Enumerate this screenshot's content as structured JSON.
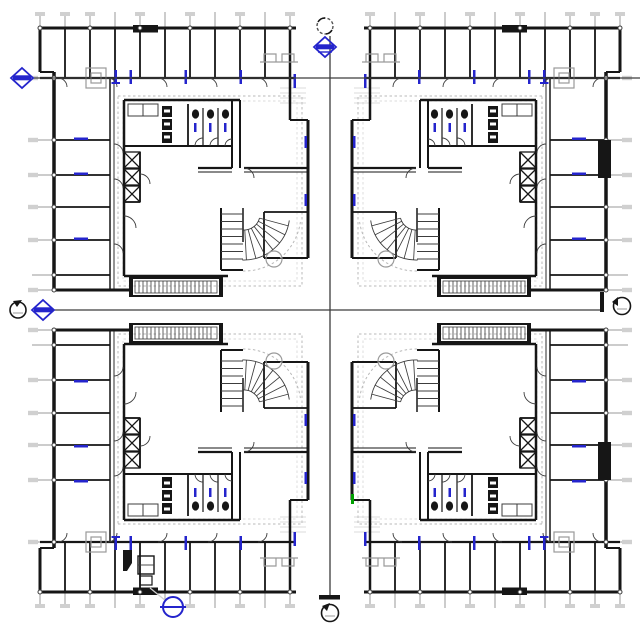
{
  "canvas": {
    "width": 640,
    "height": 640,
    "background": "#ffffff",
    "description": "Black-and-white CAD floor-plan drawing: four mirrored apartment-unit plans arranged 2x2 around crossing section lines, with blue elevation diamonds, black section-head circles, a blue detail callout, window/door marks and dimension grid ticks"
  },
  "colors": {
    "paper": "#ffffff",
    "ink": "#161616",
    "line": "#3c3c3c",
    "gray": "#9a9a9a",
    "light-gray": "#d0d0d0",
    "dashed": "#b9b9b9",
    "blue": "#2424cc",
    "green": "#00a000"
  },
  "plans": {
    "count": 4,
    "arrangement": "2x2, mirrored horizontally and vertically",
    "units": [
      "upper-left unit plan",
      "upper-right unit plan",
      "lower-left unit plan",
      "lower-right unit plan"
    ],
    "features_per_unit": [
      "perimeter room band with partitions and window ticks",
      "dashed area-boundary rectangle around unit core",
      "bathroom block with toilet stalls and fixtures",
      "three shaft boxes with X cross-bracing",
      "quarter-turn fan stair with radial treads and dashed sweep arc",
      "hatched balcony/stair strip on outer edge",
      "nested-square column symbol on corridor grid line",
      "small circle symbol near inner corner"
    ]
  },
  "markers": {
    "section_heads": [
      {
        "position": "top-center"
      },
      {
        "position": "left-middle"
      },
      {
        "position": "right-middle"
      },
      {
        "position": "bottom-center"
      }
    ],
    "elevation_diamonds": [
      {
        "position": "top-center",
        "color": "blue"
      },
      {
        "position": "upper-left",
        "color": "blue"
      },
      {
        "position": "left-middle",
        "color": "blue"
      }
    ],
    "callout": {
      "position": "bottom-left",
      "shape": "circle with horizontal bar",
      "color": "blue",
      "leader": true
    },
    "green_tick": {
      "position": "inner wall of lower-right unit"
    },
    "black_wall_fills": [
      "right edge upper",
      "right edge lower",
      "top wall of each unit"
    ]
  },
  "section_lines": {
    "vertical": {
      "x": 330,
      "from_y": 34,
      "to_y": 598
    },
    "horizontal_main": {
      "y": 310,
      "from_x": 48,
      "to_x": 604
    },
    "horizontal_upper": {
      "y": 78,
      "from_x": 32,
      "to_x": 640
    }
  },
  "aria": {
    "canvas": "Architectural floor plan sheet with four mirrored unit plans",
    "unit_tl": "Upper-left unit plan",
    "unit_tr": "Upper-right unit plan (mirrored)",
    "unit_bl": "Lower-left unit plan (mirrored)",
    "unit_br": "Lower-right unit plan (mirrored)",
    "vline": "Vertical section line with section heads and blue elevation marker",
    "hline_main": "Horizontal section line with section heads and blue elevation marker",
    "hline_upper": "Upper horizontal grid line with blue elevation marker",
    "callout": "Blue detail callout with leader line",
    "kitchen": "Kitchen fixtures in lower-left unit"
  }
}
